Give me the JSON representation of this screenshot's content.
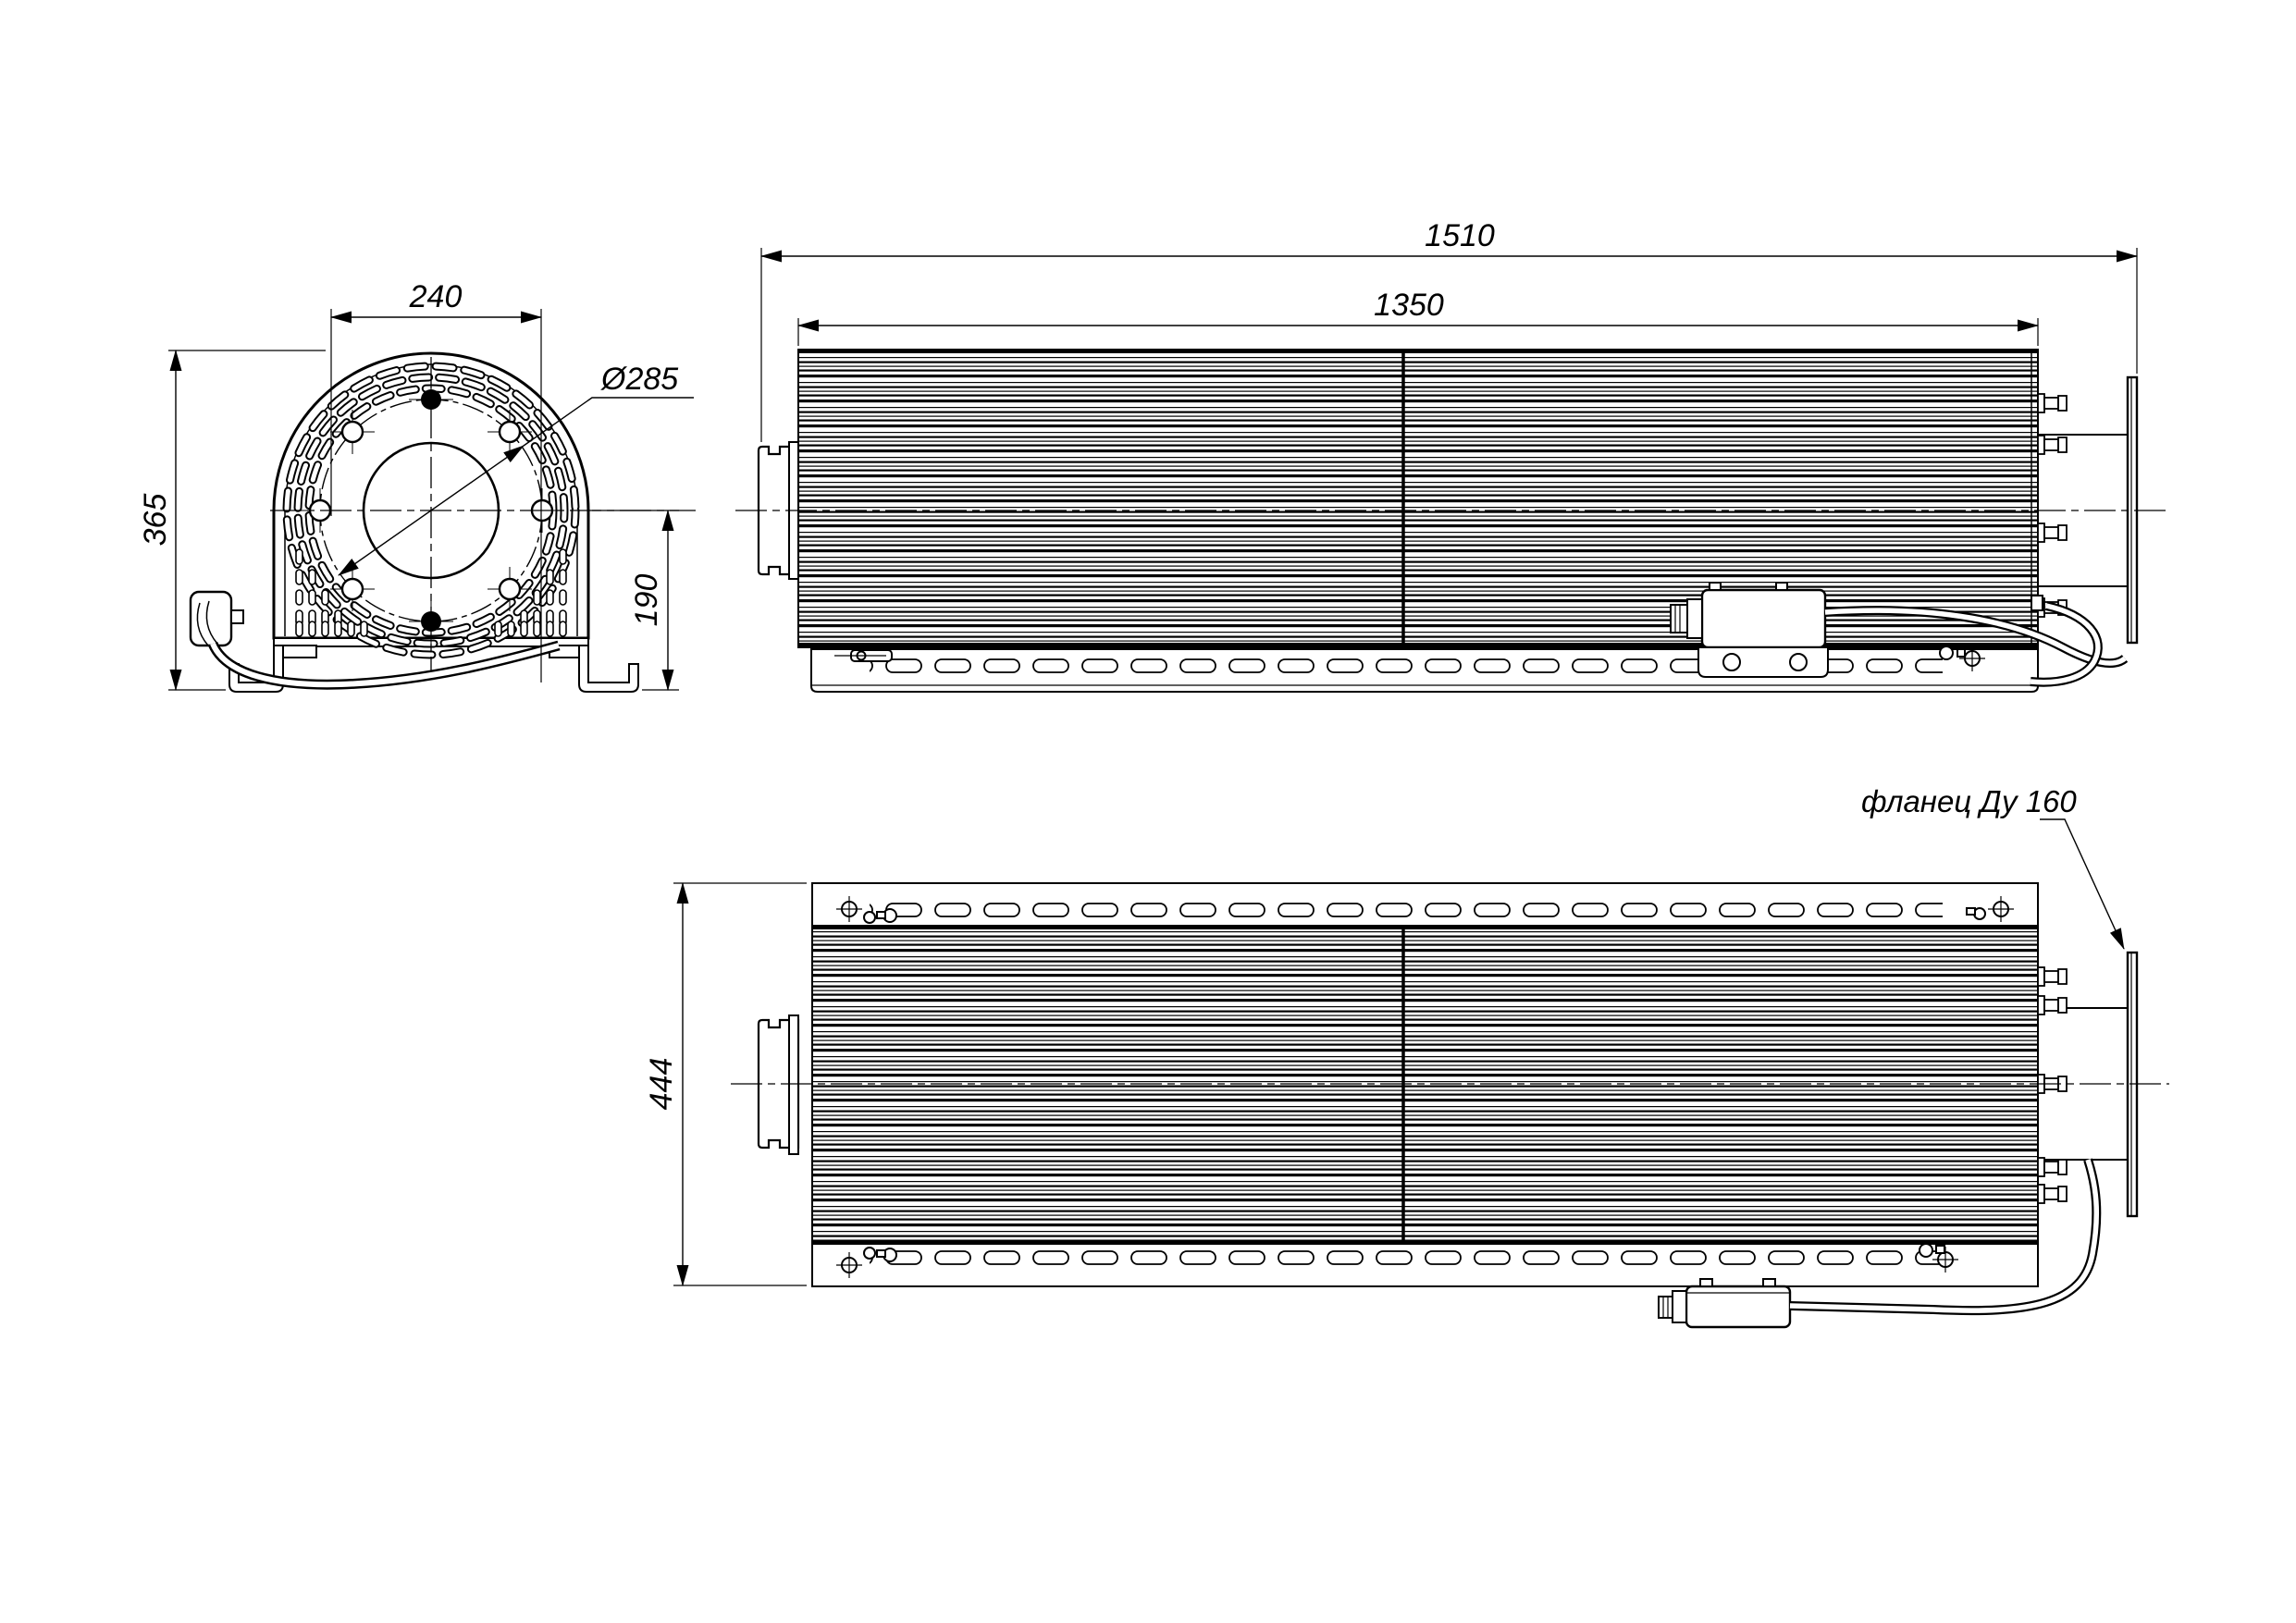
{
  "drawing": {
    "front_view": {
      "dim_width": "240",
      "dim_height": "365",
      "dim_bolt_circle": "Ø285",
      "dim_axis_height": "190"
    },
    "side_view": {
      "dim_overall_length": "1510",
      "dim_finned_length": "1350"
    },
    "plan_view": {
      "dim_width": "444",
      "flange_label": "фланец Ду 160"
    }
  }
}
